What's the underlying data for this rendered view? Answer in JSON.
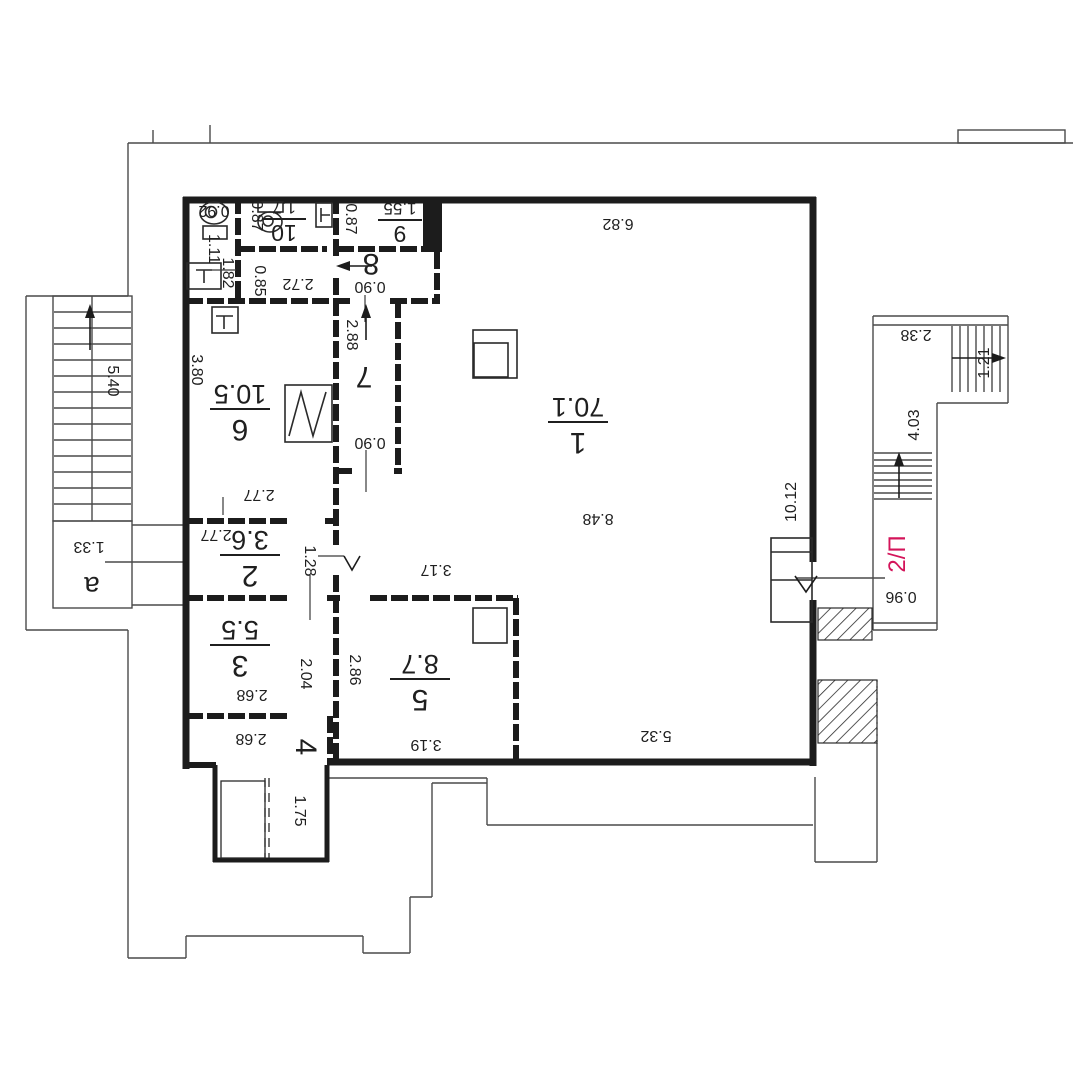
{
  "plan": {
    "background": "#ffffff",
    "wall_color": "#1c1c1c",
    "thin_color": "#4a4a4a",
    "text_color": "#1f1f1f",
    "accent_color": "#d4145a",
    "floor_label": {
      "text": "2/П",
      "x": 897,
      "y": 554,
      "rot": -90
    },
    "entrance_label": {
      "text": "a",
      "x": 92,
      "y": 586,
      "rot": 180
    },
    "rooms": [
      {
        "num": "1",
        "area": "70.1",
        "x": 578,
        "y": 425,
        "rot": 180,
        "size": "big"
      },
      {
        "num": "2",
        "area": "3.6",
        "x": 250,
        "y": 558,
        "rot": 180,
        "size": "big"
      },
      {
        "num": "3",
        "area": "5.5",
        "x": 240,
        "y": 648,
        "rot": 180,
        "size": "big"
      },
      {
        "num": "4",
        "area": null,
        "x": 306,
        "y": 747,
        "rot": 90,
        "size": "big"
      },
      {
        "num": "5",
        "area": "8.7",
        "x": 420,
        "y": 682,
        "rot": 180,
        "size": "big"
      },
      {
        "num": "6",
        "area": "10.5",
        "x": 240,
        "y": 412,
        "rot": 180,
        "size": "big"
      },
      {
        "num": "7",
        "area": null,
        "x": 364,
        "y": 377,
        "rot": 180,
        "size": "big"
      },
      {
        "num": "8",
        "area": null,
        "x": 371,
        "y": 264,
        "rot": 180,
        "size": "big"
      },
      {
        "num": "9",
        "area": "1.55",
        "x": 400,
        "y": 221,
        "rot": 180,
        "size": "small"
      },
      {
        "num": "10",
        "area": "1.7",
        "x": 284,
        "y": 220,
        "rot": 180,
        "size": "small"
      }
    ],
    "dimensions": [
      {
        "t": "6.82",
        "x": 618,
        "y": 224,
        "r": 180
      },
      {
        "t": "8.48",
        "x": 598,
        "y": 519,
        "r": 180
      },
      {
        "t": "10.12",
        "x": 791,
        "y": 502,
        "r": -90
      },
      {
        "t": "5.32",
        "x": 656,
        "y": 736,
        "r": 180
      },
      {
        "t": "0.92",
        "x": 214,
        "y": 211,
        "r": 180
      },
      {
        "t": "0.87",
        "x": 257,
        "y": 216,
        "r": 90
      },
      {
        "t": "0.87",
        "x": 351,
        "y": 219,
        "r": 90
      },
      {
        "t": "1.11",
        "x": 214,
        "y": 249,
        "r": 90
      },
      {
        "t": "1.82",
        "x": 228,
        "y": 273,
        "r": 90
      },
      {
        "t": "0.85",
        "x": 260,
        "y": 281,
        "r": 90
      },
      {
        "t": "2.72",
        "x": 298,
        "y": 284,
        "r": 180
      },
      {
        "t": "0.90",
        "x": 370,
        "y": 287,
        "r": 180
      },
      {
        "t": "2.88",
        "x": 352,
        "y": 335,
        "r": 90
      },
      {
        "t": "0.90",
        "x": 370,
        "y": 443,
        "r": 180
      },
      {
        "t": "3.80",
        "x": 197,
        "y": 370,
        "r": 90
      },
      {
        "t": "2.77",
        "x": 259,
        "y": 495,
        "r": 180
      },
      {
        "t": "2.77",
        "x": 216,
        "y": 535,
        "r": 180
      },
      {
        "t": "1.28",
        "x": 310,
        "y": 561,
        "r": 90
      },
      {
        "t": "3.17",
        "x": 436,
        "y": 570,
        "r": 180
      },
      {
        "t": "2.04",
        "x": 306,
        "y": 674,
        "r": 90
      },
      {
        "t": "2.86",
        "x": 355,
        "y": 670,
        "r": 90
      },
      {
        "t": "2.68",
        "x": 252,
        "y": 695,
        "r": 180
      },
      {
        "t": "2.68",
        "x": 251,
        "y": 739,
        "r": 180
      },
      {
        "t": "3.19",
        "x": 426,
        "y": 745,
        "r": 180
      },
      {
        "t": "1.75",
        "x": 300,
        "y": 811,
        "r": 90
      },
      {
        "t": "5.40",
        "x": 113,
        "y": 381,
        "r": 90
      },
      {
        "t": "1.33",
        "x": 89,
        "y": 547,
        "r": 180
      },
      {
        "t": "2.38",
        "x": 916,
        "y": 335,
        "r": 180
      },
      {
        "t": "1.21",
        "x": 984,
        "y": 363,
        "r": -90
      },
      {
        "t": "4.03",
        "x": 914,
        "y": 425,
        "r": -90
      },
      {
        "t": "0.96",
        "x": 901,
        "y": 597,
        "r": 180
      }
    ]
  }
}
